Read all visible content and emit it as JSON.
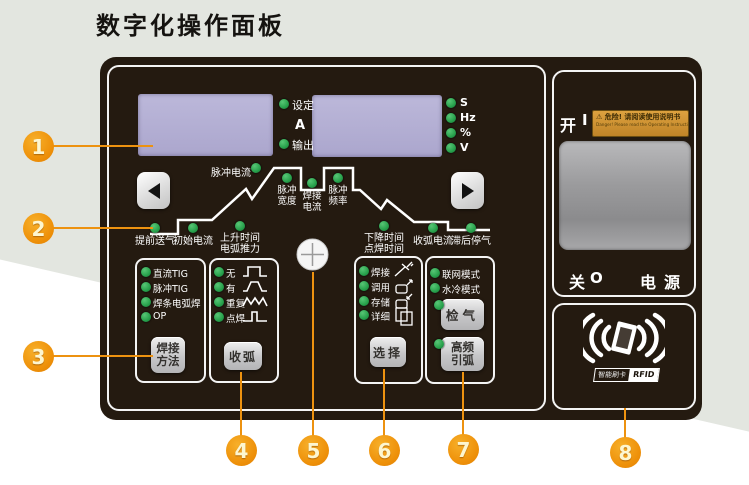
{
  "title": "数字化操作面板",
  "colors": {
    "accent_orange": "#ee9009",
    "led_green": "#27a04b",
    "display_lavender": "#b6b1d6",
    "panel_dark": "#241a10",
    "background_sage": "#e3e6e0"
  },
  "meters": {
    "set_label": "设定",
    "amp_unit": "A",
    "output_label": "输出",
    "right_units": [
      "S",
      "Hz",
      "%",
      "V"
    ],
    "pulse_current_label": "脉冲电流"
  },
  "waveform": {
    "pulse_width": {
      "l1": "脉冲",
      "l2": "宽度"
    },
    "weld_current": {
      "l1": "焊接",
      "l2": "电流"
    },
    "pulse_freq": {
      "l1": "脉冲",
      "l2": "频率"
    },
    "pre_gas": "提前送气",
    "initial_current": "初始电流",
    "upslope": {
      "l1": "上升时间",
      "l2": "电弧推力"
    },
    "downslope": {
      "l1": "下降时间",
      "l2": "点焊时间"
    },
    "crater_current": "收弧电流",
    "post_gas": "滞后停气"
  },
  "groups": {
    "method": {
      "leds": [
        "直流TIG",
        "脉冲TIG",
        "焊条电弧焊",
        "OP"
      ],
      "button": {
        "l1": "焊接",
        "l2": "方法"
      }
    },
    "crater": {
      "leds": [
        "无",
        "有",
        "重复",
        "点焊"
      ],
      "button": "收弧"
    },
    "select": {
      "leds": [
        "焊接",
        "调用",
        "存储",
        "详细"
      ],
      "button": "选择"
    },
    "modes": {
      "leds": [
        "联网模式",
        "水冷模式"
      ],
      "gas_check_button": "检气",
      "hf_arc_button": {
        "l1": "高频",
        "l2": "引弧"
      }
    }
  },
  "power": {
    "on_label": "开",
    "on_symbol": "I",
    "warning_line1": "⚠ 危险! 请阅读使用说明书",
    "warning_line2": "Danger! Please read the Operating Instructions",
    "off_label": "关",
    "off_symbol": "O",
    "mains_label": "电源",
    "rfid_caption": "智能刷卡",
    "rfid_label": "RFID"
  },
  "callouts": [
    "1",
    "2",
    "3",
    "4",
    "5",
    "6",
    "7",
    "8"
  ]
}
